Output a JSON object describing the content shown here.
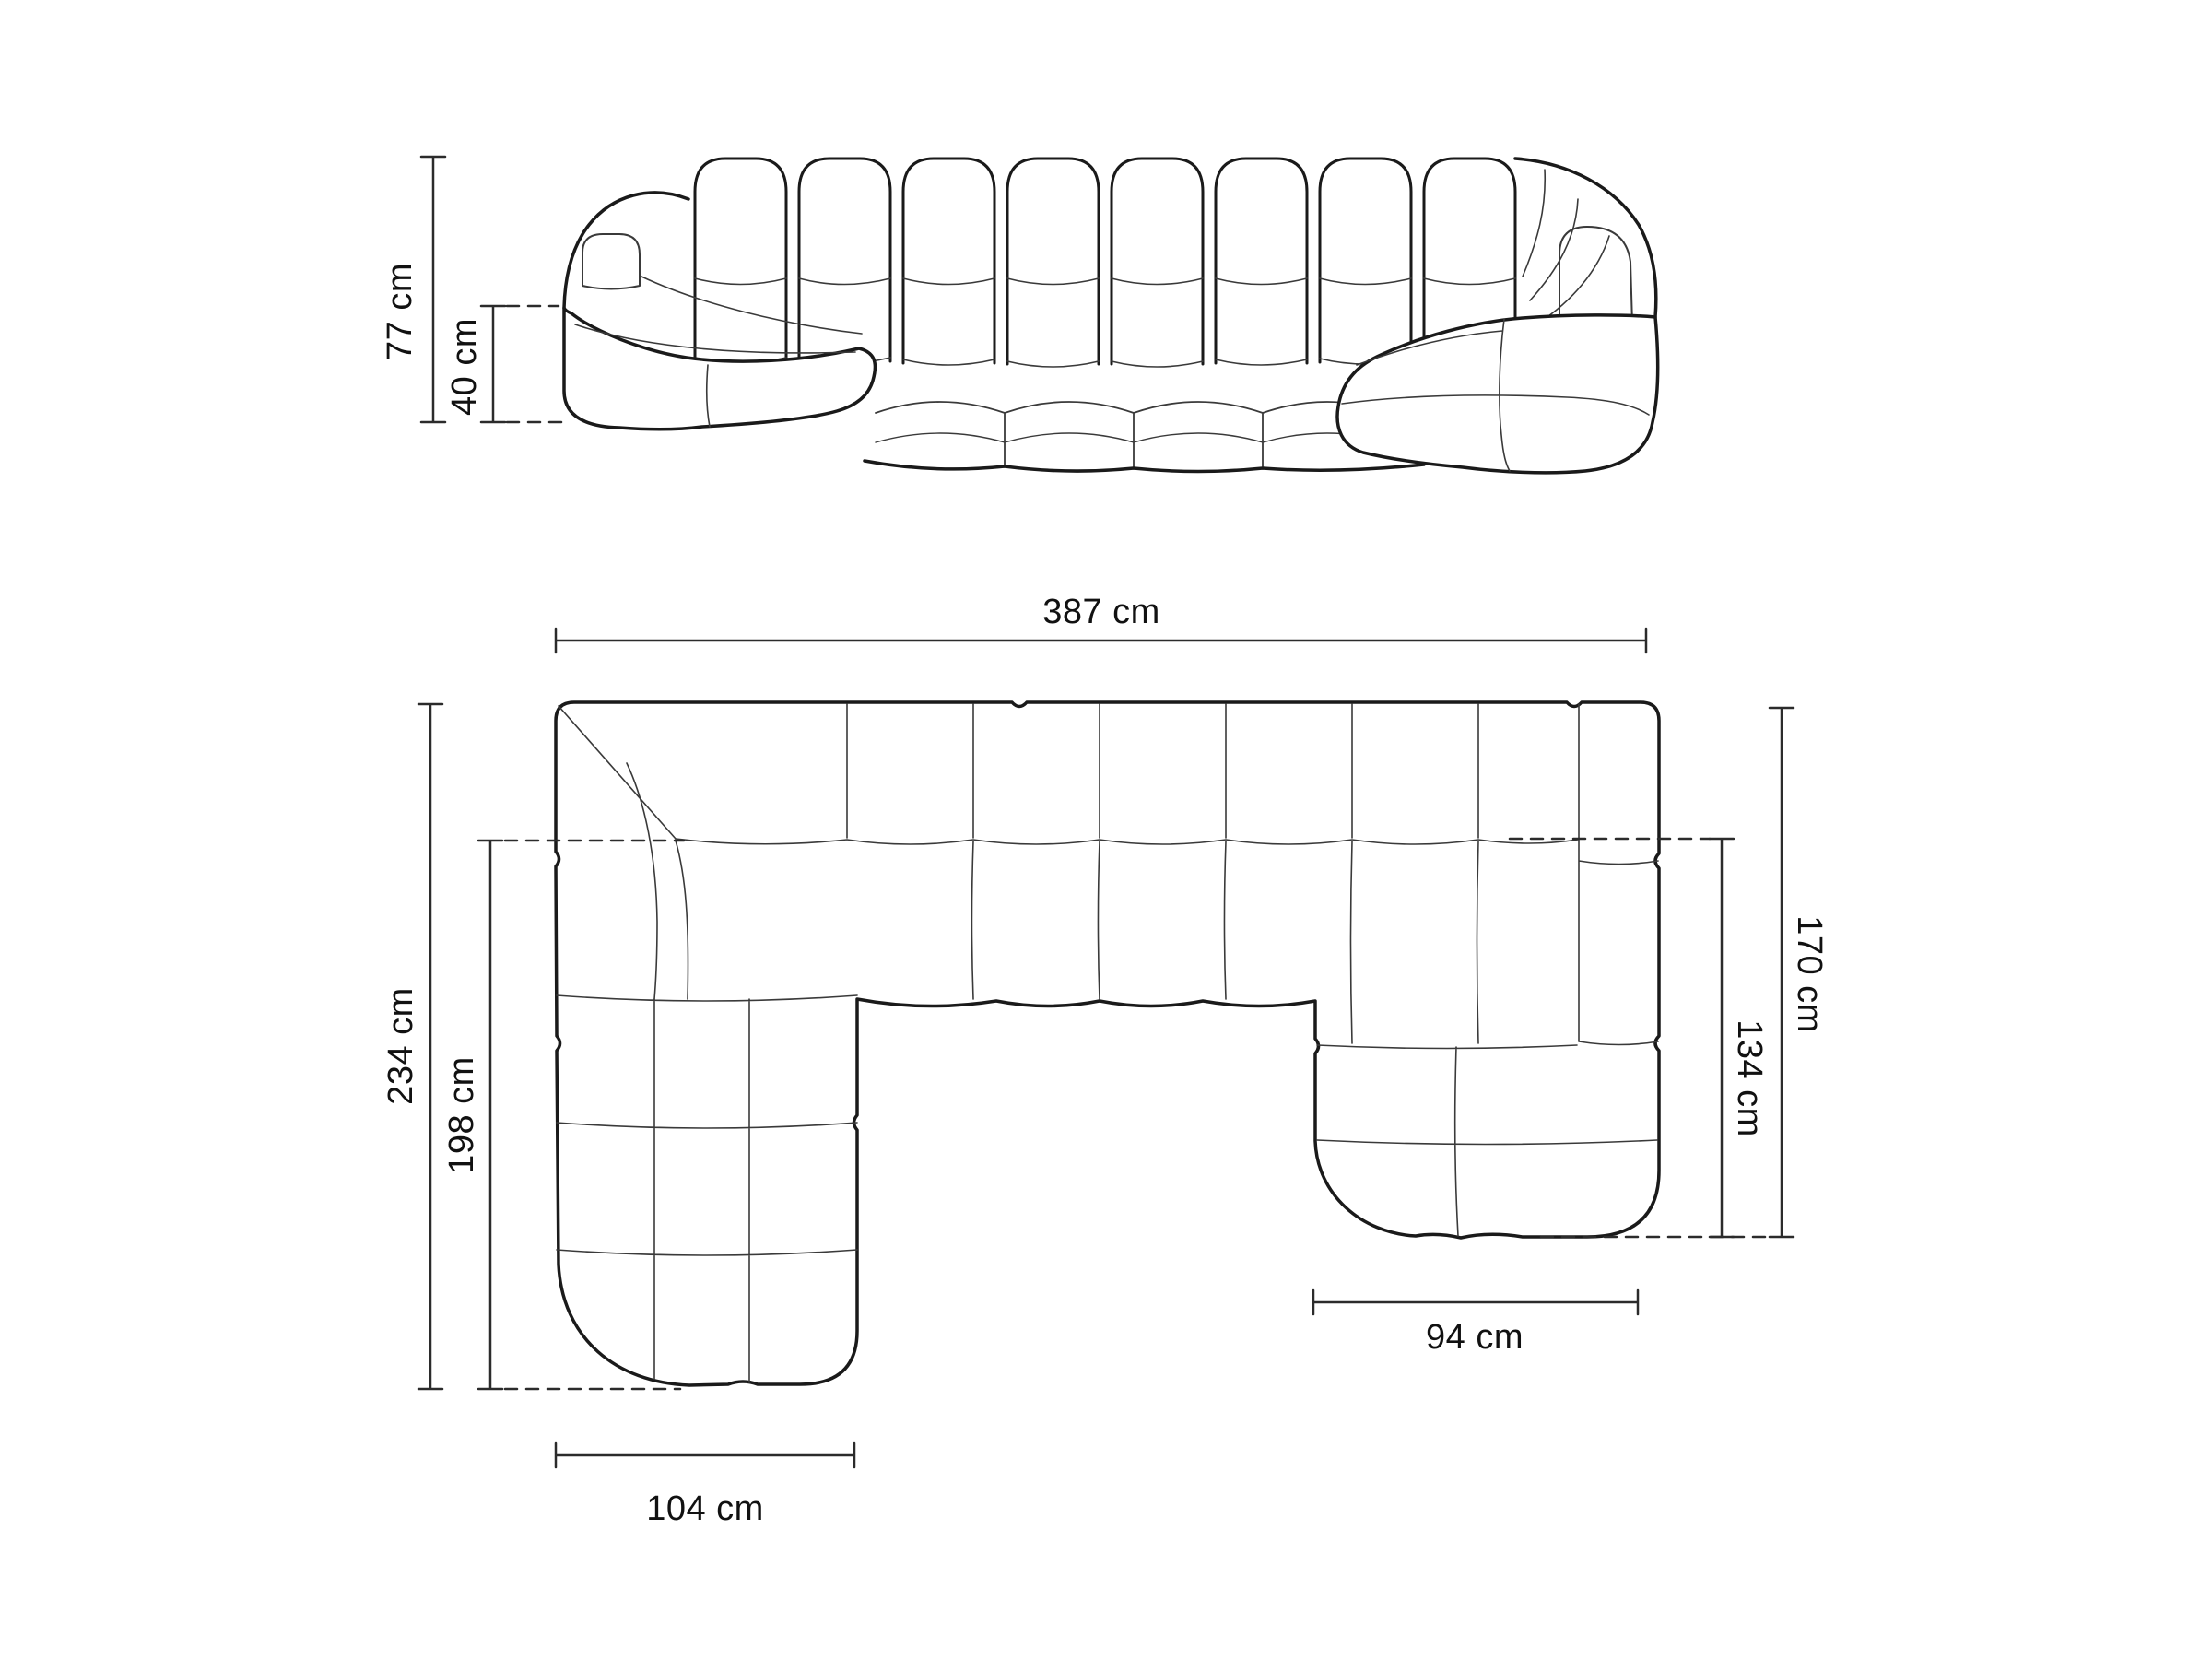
{
  "colors": {
    "background": "#ffffff",
    "sofa_outline": "#1a1a1a",
    "sofa_seam": "#3a3a3a",
    "dimension_line": "#2b2b2b",
    "label_text": "#111111"
  },
  "front_view": {
    "dimensions": {
      "overall_height": "77 cm",
      "seat_height": "40 cm"
    }
  },
  "top_view": {
    "dimensions": {
      "overall_width": "387 cm",
      "overall_depth_left": "234 cm",
      "inner_depth_left": "198 cm",
      "overall_depth_right": "170 cm",
      "inner_depth_right": "134 cm",
      "right_chaise_width": "94 cm",
      "left_chaise_width": "104 cm"
    }
  }
}
